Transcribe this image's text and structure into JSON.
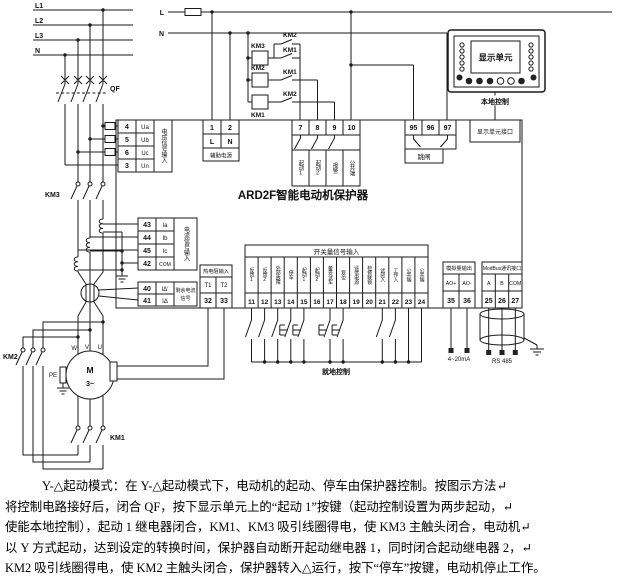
{
  "colors": {
    "ink": "#1a1a1a",
    "background": "#ffffff"
  },
  "power": {
    "bus_labels": [
      "L1",
      "L2",
      "L3",
      "N"
    ],
    "control_l": "L",
    "control_n": "N"
  },
  "breaker": {
    "label": "QF"
  },
  "contactors": {
    "main": "KM3",
    "delta": "KM2",
    "line": "KM1"
  },
  "control_circuit": {
    "rows": [
      {
        "coil": "KM3",
        "contact_upper": "KM2",
        "contact_lower": "KM1"
      },
      {
        "coil": "KM2",
        "contact": "KM1"
      },
      {
        "coil": "KM1",
        "contact": "KM2"
      }
    ]
  },
  "device": {
    "title": "ARD2F智能电动机保护器"
  },
  "aux_power": {
    "terminals": [
      "1",
      "2"
    ],
    "names": [
      "L",
      "N"
    ],
    "label": "辅助电源"
  },
  "relay_outputs": {
    "terminals": [
      "7",
      "8",
      "9",
      "10"
    ],
    "labels": [
      "起动1",
      "起动2",
      "报警",
      "公共端"
    ]
  },
  "trip_output": {
    "terminals": [
      "95",
      "96",
      "97"
    ],
    "label": "跳闸"
  },
  "display_port": {
    "label": "显示单元接口"
  },
  "display_unit": {
    "screen": "显示单元",
    "caption": "本地控制"
  },
  "voltage_input": {
    "terminals": [
      "4",
      "5",
      "6",
      "3"
    ],
    "names": [
      "Ua",
      "Ub",
      "Uc",
      "Un"
    ],
    "label": "电压信号输入"
  },
  "current_input": {
    "terminals": [
      "43",
      "44",
      "45",
      "42"
    ],
    "names": [
      "Ia",
      "Ib",
      "Ic",
      "COM"
    ],
    "label": "电流信号输入"
  },
  "residual_input": {
    "terminals": [
      "40",
      "41"
    ],
    "names": [
      "IΔ′",
      "IΔ"
    ],
    "label_line1": "剩余电流",
    "label_line2": "信号"
  },
  "temp_input": {
    "header": "热电阻输入",
    "names": [
      "T1",
      "T2"
    ],
    "terminals": [
      "32",
      "33"
    ]
  },
  "digital_inputs": {
    "header": "开关量信号输入",
    "labels": [
      "反馈1",
      "反馈2",
      "外部故障",
      "停车",
      "起动1",
      "起动2",
      "备妥试车",
      "复位",
      "遥信电源",
      "检修联锁",
      "试验入",
      "工作入",
      "公共端",
      "公共端"
    ],
    "terminals": [
      "11",
      "12",
      "13",
      "14",
      "15",
      "16",
      "17",
      "18",
      "19",
      "20",
      "21",
      "22",
      "23",
      "24"
    ],
    "caption": "就地控制"
  },
  "analog_output": {
    "header": "模拟量输出",
    "names": [
      "AO+",
      "AO-"
    ],
    "terminals": [
      "35",
      "36"
    ],
    "note": "4~20mA"
  },
  "comm_port": {
    "header": "ModBus通讯接口",
    "names": [
      "A",
      "B",
      "COM"
    ],
    "terminals": [
      "25",
      "26",
      "27"
    ],
    "note": "RS 485"
  },
  "motor": {
    "symbol": "M",
    "phase": "3~",
    "terminal_w": "W",
    "terminal_v": "V",
    "terminal_u": "U",
    "pe": "PE"
  },
  "description": {
    "lines": [
      "Y-△起动模式：在 Y-△起动模式下，电动机的起动、停车由保护器控制。按图示方法↵",
      "将控制电路接好后，闭合 QF，按下显示单元上的“起动 1”按键（起动控制设置为两步起动，↵",
      "使能本地控制），起动 1 继电器闭合，KM1、KM3 吸引线圈得电，使 KM3 主触头闭合，电动机↵",
      "以 Y 方式起动，达到设定的转换时间，保护器自动断开起动继电器 1，同时闭合起动继电器 2，↵",
      "KM2 吸引线圈得电，使 KM2 主触头闭合，保护器转入△运行，按下“停车”按键，电动机停止工作。"
    ]
  }
}
